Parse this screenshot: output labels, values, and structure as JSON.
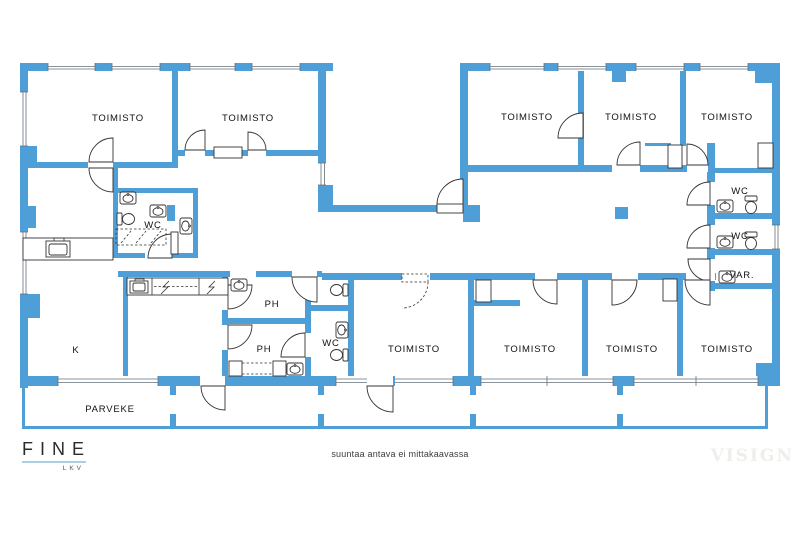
{
  "colors": {
    "wall": "#4e9fd8",
    "line": "#333333",
    "wline": "#66707a",
    "label": "#111111",
    "watermark": "#efeeea",
    "logotext": "#2b2b2b",
    "logorule": "#a9d0e4",
    "logosub": "#555555",
    "disclaimer": "#3c3c3c"
  },
  "rooms": [
    {
      "name": "toimisto-nw-1",
      "label": "TOIMISTO"
    },
    {
      "name": "toimisto-nw-2",
      "label": "TOIMISTO"
    },
    {
      "name": "toimisto-ne-1",
      "label": "TOIMISTO"
    },
    {
      "name": "toimisto-ne-2",
      "label": "TOIMISTO"
    },
    {
      "name": "toimisto-ne-3",
      "label": "TOIMISTO"
    },
    {
      "name": "wc-east-1",
      "label": "WC"
    },
    {
      "name": "wc-east-2",
      "label": "WC"
    },
    {
      "name": "var-storage",
      "label": "VAR."
    },
    {
      "name": "wc-west",
      "label": "WC"
    },
    {
      "name": "ph-1",
      "label": "PH"
    },
    {
      "name": "ph-2",
      "label": "PH"
    },
    {
      "name": "wc-center",
      "label": "WC"
    },
    {
      "name": "kitchen",
      "label": "K"
    },
    {
      "name": "toimisto-s-1",
      "label": "TOIMISTO"
    },
    {
      "name": "toimisto-s-2",
      "label": "TOIMISTO"
    },
    {
      "name": "toimisto-s-3",
      "label": "TOIMISTO"
    },
    {
      "name": "toimisto-s-4",
      "label": "TOIMISTO"
    },
    {
      "name": "parveke-balcony",
      "label": "PARVEKE"
    }
  ],
  "footer": {
    "brand": "FINE",
    "brand_sub": "LKV",
    "disclaimer": "suuntaa antava ei mittakaavassa",
    "watermark": "VISIGN"
  }
}
